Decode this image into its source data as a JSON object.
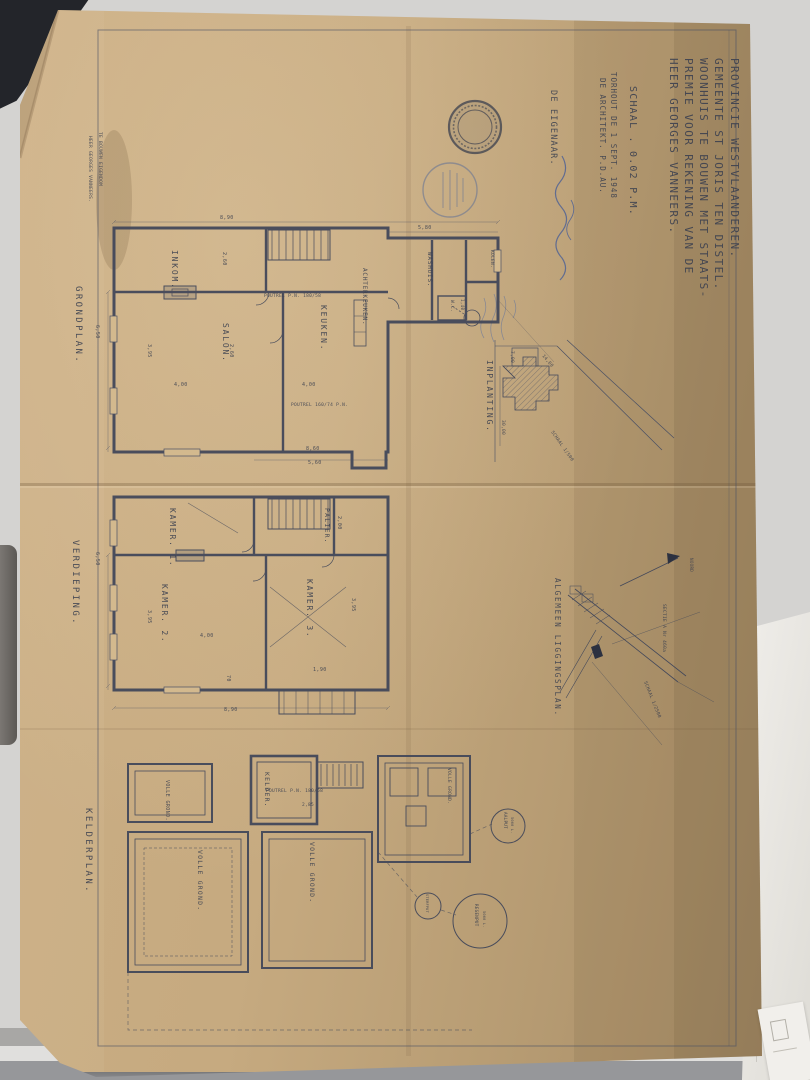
{
  "title_block": {
    "line_1": "PROVINCIE WESTVLAANDEREN.",
    "line_2": "GEMEENTE ST JORIS TEN DISTEL.",
    "line_3": "WOONHUIS TE BOUWEN MET STAATS-",
    "line_4": "PREMIE VOOR REKENING VAN DE",
    "line_5": "HEER GEORGES VANNEERS.",
    "scale": "SCHAAL . 0.02 P.M.",
    "place_date": "TORHOUT DE 1 SEPT. 1948",
    "architect": "DE ARCHITEKT. P.D.AU.",
    "owner": "DE EIGENAAR."
  },
  "margin_note": {
    "line_1": "TE BOUWEN EIGENDOM",
    "line_2": "HEER GEORGES VANNEERS."
  },
  "grondplan": {
    "title": "GRONDPLAN.",
    "rooms": {
      "inkom": "INKOM.",
      "salon": "SALON.",
      "keuken": "KEUKEN.",
      "achterkeuken": "ACHTERKEUKEN.",
      "washuis": "WASHUIS.",
      "kolen": "KOLEN.",
      "wc": "W.C."
    },
    "beams": {
      "beam_1": "POUTREL P.N. 180/58",
      "beam_2": "POUTREL 160/74 P.N."
    },
    "dims": {
      "width_top": "8,90",
      "annex_width": "5,80",
      "left": "6,50",
      "salon_w": "4,00",
      "salon_h": "3,95",
      "inkom_w": "2,60",
      "keuken_w": "4,00",
      "keuken_h": "2,60",
      "bottom_1": "8,60",
      "bottom_2": "5,60",
      "wc": "1,40"
    }
  },
  "inplanting": {
    "title": "INPLANTING.",
    "scale": "SCHAAL 1/500",
    "dims": {
      "d1": "30,00",
      "d2": "14,00",
      "d3": "7,00"
    }
  },
  "verdieping": {
    "title": "VERDIEPING.",
    "rooms": {
      "kamer1": "KAMER. 1.",
      "kamer2": "KAMER. 2.",
      "kamer3": "KAMER. 3.",
      "palier": "PALIER."
    },
    "dims": {
      "left": "6,50",
      "bottom": "8,90",
      "k2_w": "4,00",
      "k2_h": "3,95",
      "k3_h": "3,95",
      "terrace": "1,90",
      "step": "70",
      "palier": "2,00"
    }
  },
  "ligging": {
    "title": "ALGEMEEN LIGGINGSPLAN.",
    "north": "NOORD",
    "sectie": "SECTIE A Nr 460a",
    "scale": "SCHAAL 1/2500"
  },
  "kelderplan": {
    "title": "KELDERPLAN.",
    "rooms": {
      "kelder": "KELDER.",
      "volle_grond": "VOLLE GROND."
    },
    "beam": "POUTREL P.N. 180/58",
    "dims": {
      "kelder_w": "2,85"
    },
    "wells": {
      "aalput": "AALPUT",
      "aalput_cap": "5000 L.",
      "regenput": "REGENPUT",
      "regenput_cap": "5000 L.",
      "sterfput": "STERFPUT"
    }
  }
}
